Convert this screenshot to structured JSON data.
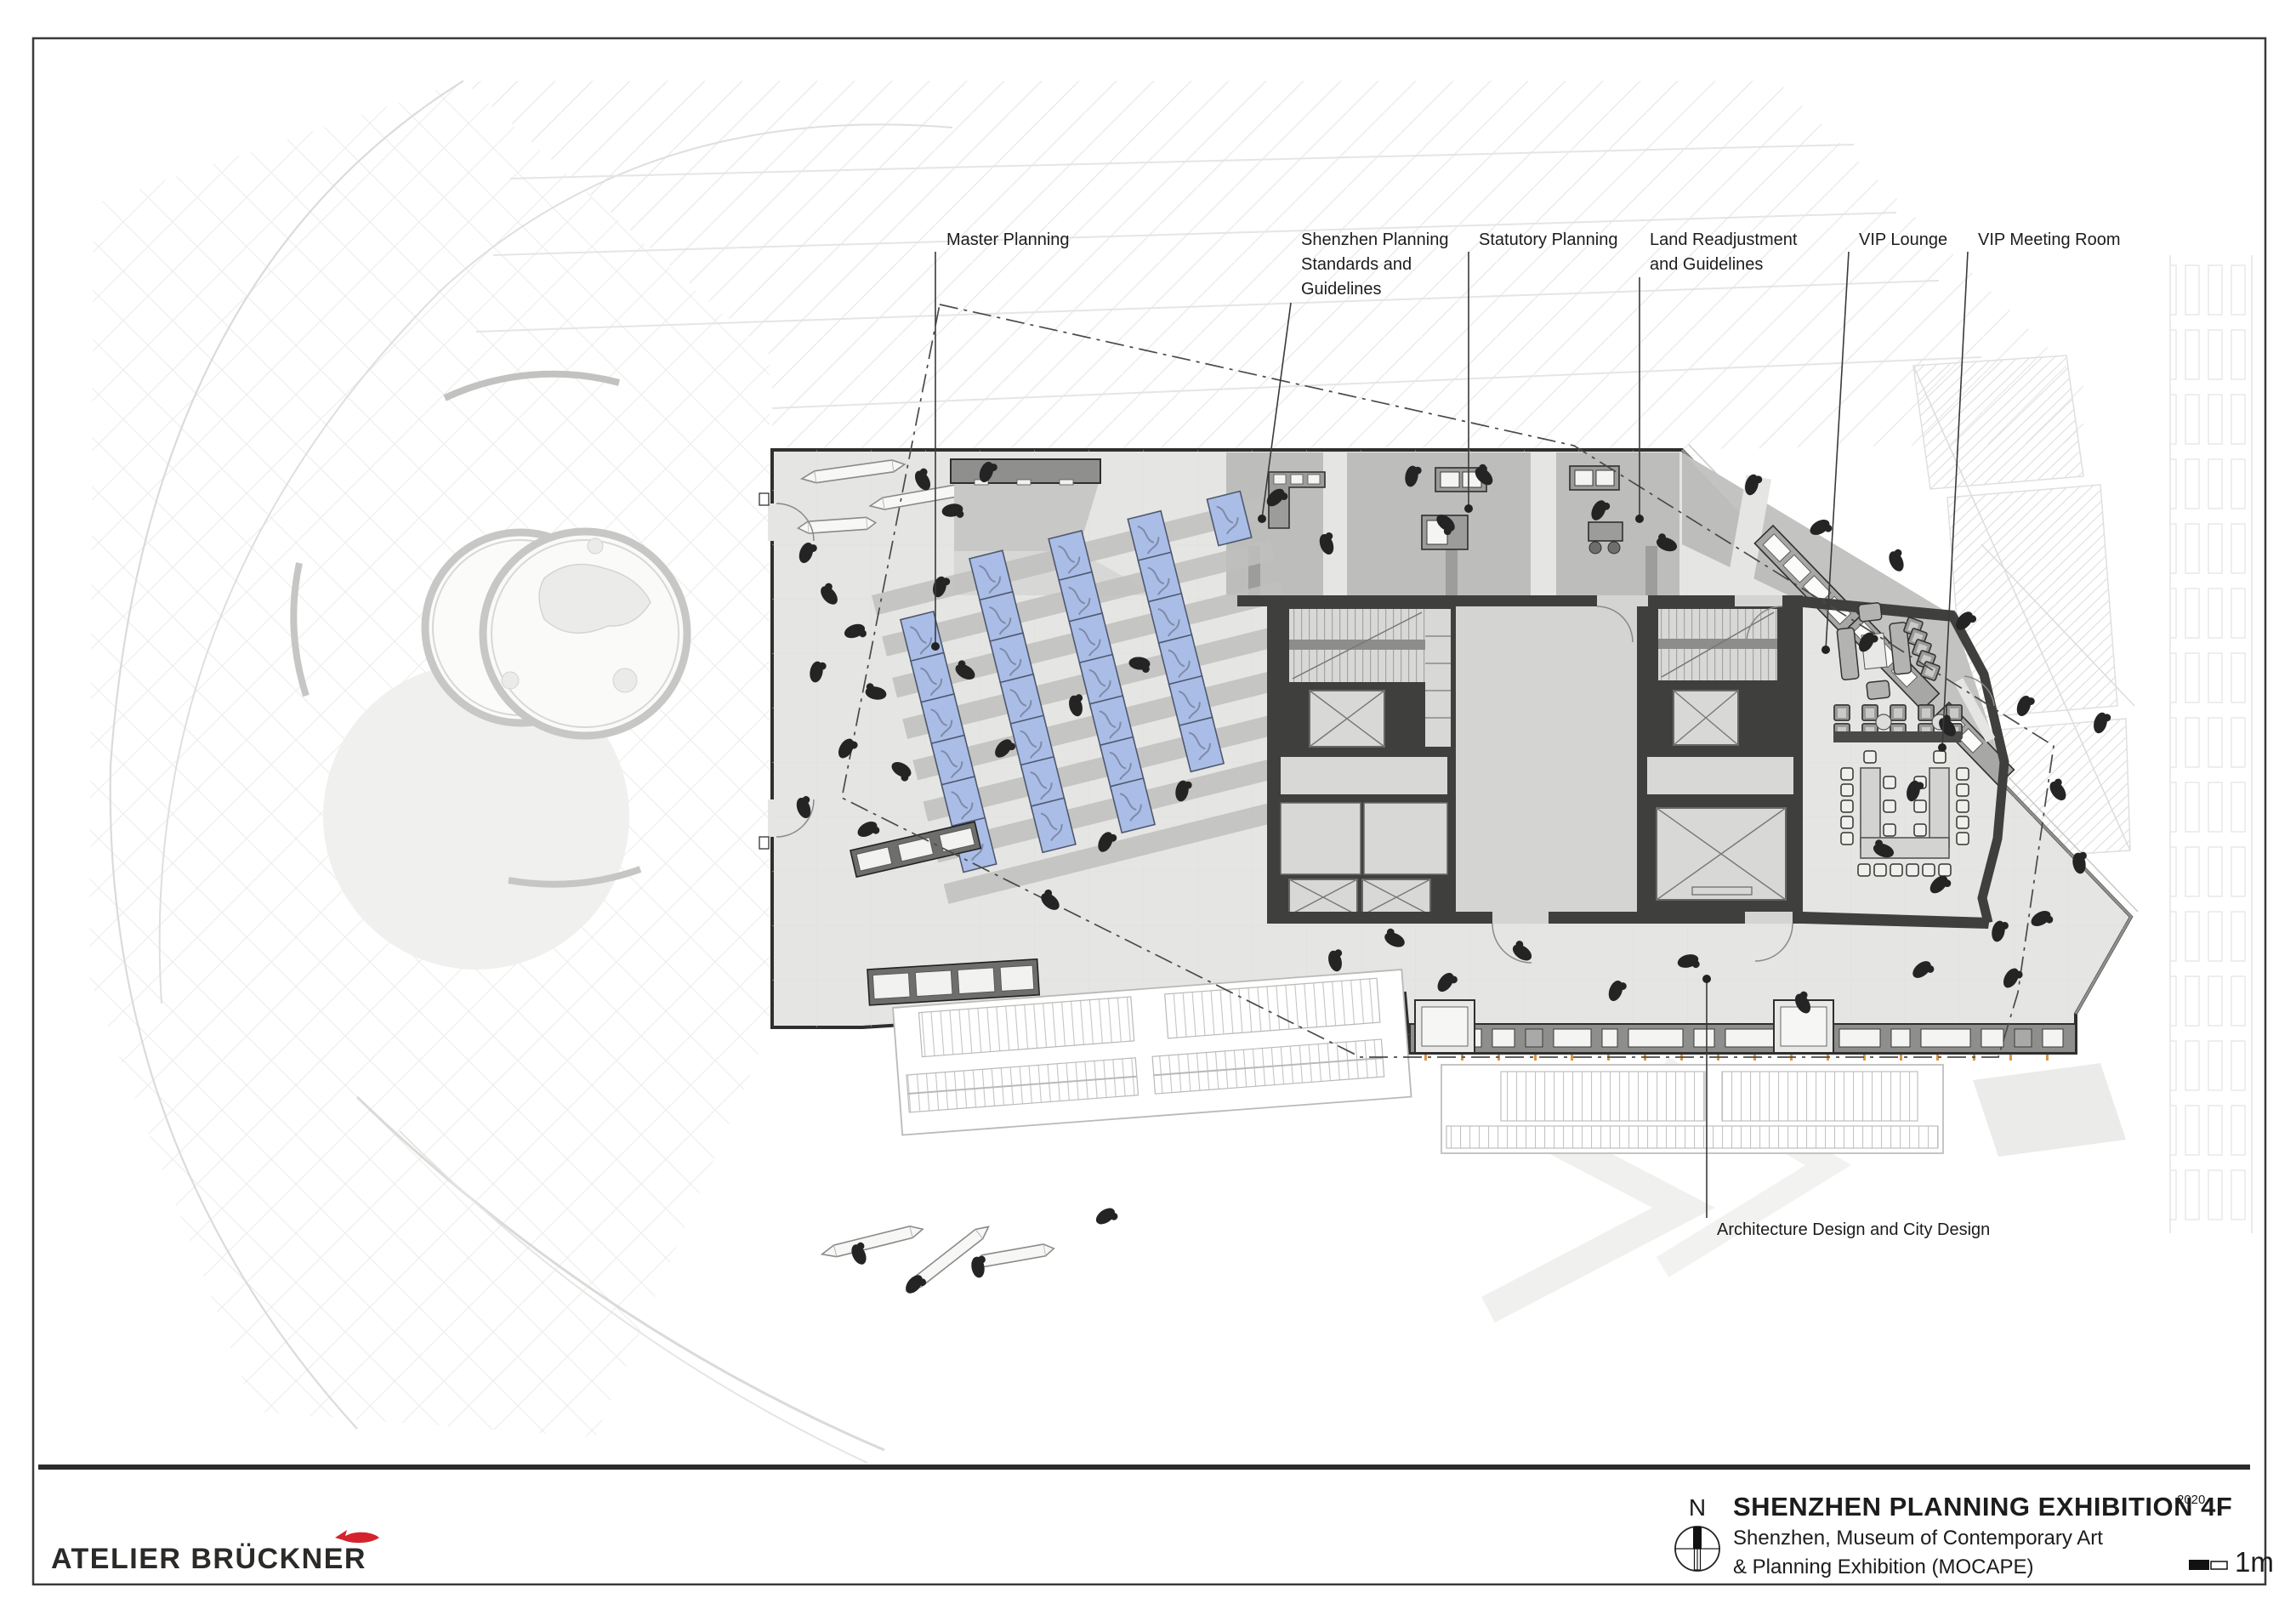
{
  "annotations": {
    "labels": [
      {
        "id": "master-planning",
        "lines": [
          "Master Planning"
        ]
      },
      {
        "id": "shenzhen-planning-standards",
        "lines": [
          "Shenzhen Planning",
          "Standards and",
          "Guidelines"
        ]
      },
      {
        "id": "statutory-planning",
        "lines": [
          "Statutory Planning"
        ]
      },
      {
        "id": "land-readjustment",
        "lines": [
          "Land Readjustment",
          "and Guidelines"
        ]
      },
      {
        "id": "vip-lounge",
        "lines": [
          "VIP Lounge"
        ]
      },
      {
        "id": "vip-meeting-room",
        "lines": [
          "VIP Meeting Room"
        ]
      },
      {
        "id": "architecture-design",
        "lines": [
          "Architecture Design and City Design"
        ]
      }
    ]
  },
  "title_block": {
    "north_label": "N",
    "title": "SHENZHEN PLANNING EXHIBITION 4F",
    "title_superscript": "2020",
    "subtitle_line1": "Shenzhen, Museum of Contemporary Art",
    "subtitle_line2": "& Planning Exhibition (MOCAPE)",
    "scale_label": "1m"
  },
  "branding": {
    "studio_name": "ATELIER BRÜCKNER"
  },
  "icons": {
    "north_compass": "compass-rose-icon",
    "scale_bar": "scale-bar-icon",
    "logo_mark": "red-fish-icon"
  },
  "colors": {
    "logo_red": "#d5232e",
    "wall_dark": "#3f3f3e",
    "floor_light": "#e5e5e3",
    "exhibit_band": "#bdbdbb",
    "model_mat_blue": "#aabde6",
    "tick_orange": "#d98a2b"
  }
}
